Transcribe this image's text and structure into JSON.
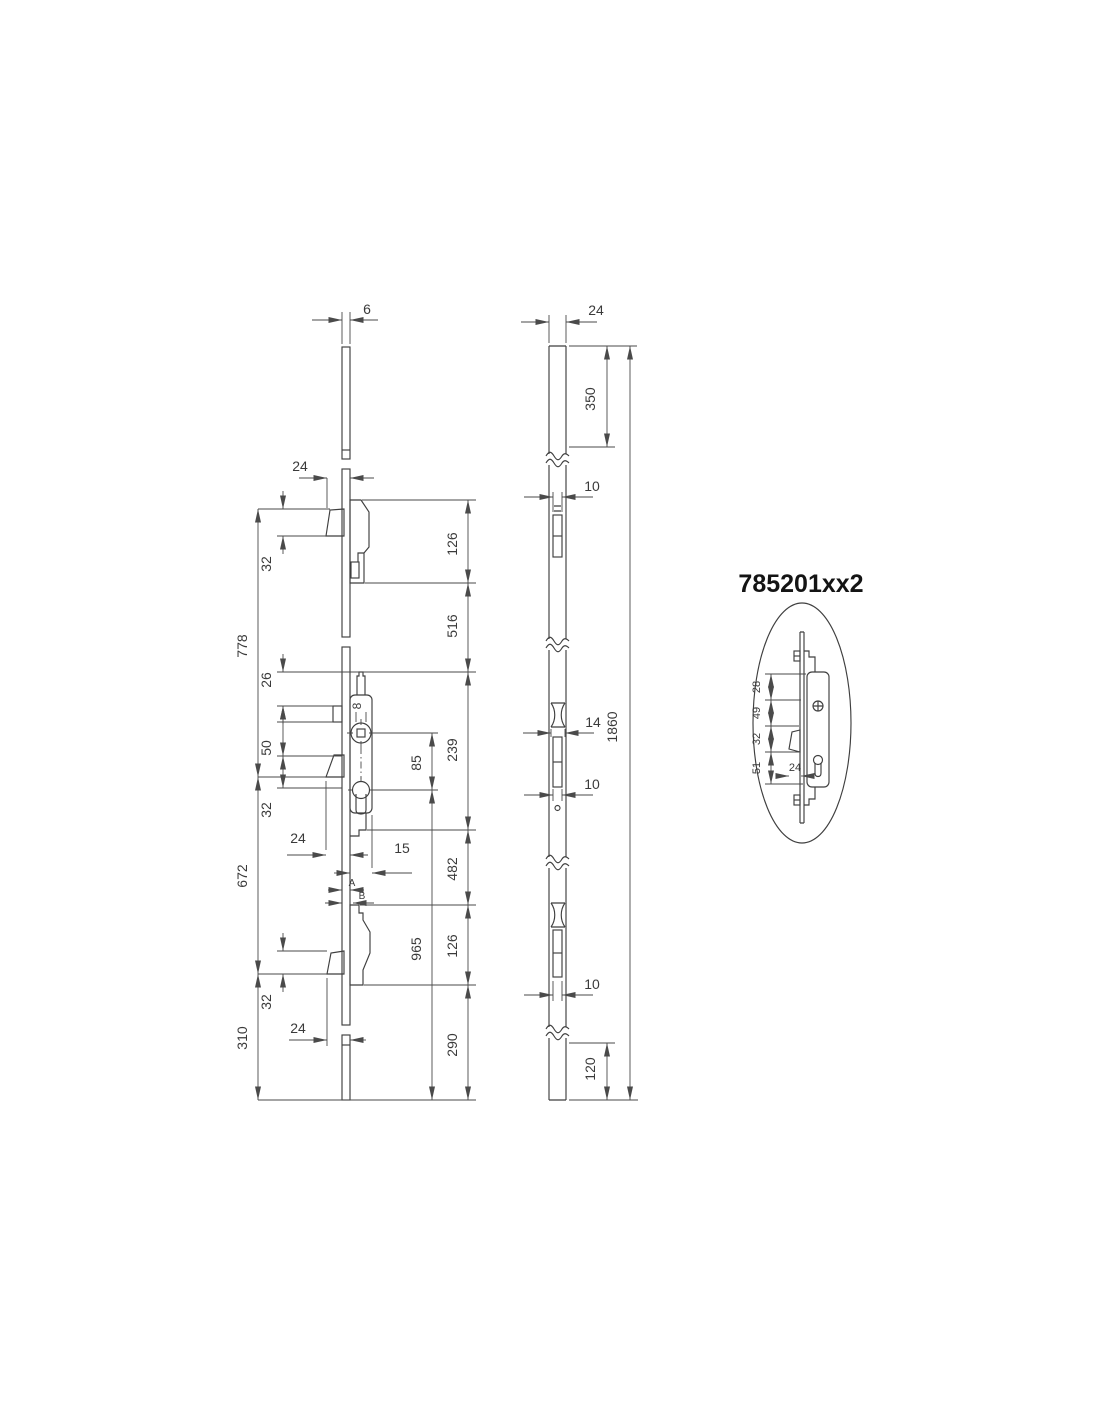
{
  "detail": {
    "part_number": "785201xx2",
    "d28": "28",
    "d49": "49",
    "d32": "32",
    "d51": "51",
    "d24": "24"
  },
  "side_view": {
    "thickness": "6",
    "top_hook": {
      "projection": "24",
      "height": "32"
    },
    "left_chain": {
      "a": "778",
      "b": "672",
      "c": "310"
    },
    "gearbox": {
      "d26": "26",
      "d50": "50",
      "d32": "32",
      "square": "8",
      "spacing": "85",
      "d24": "24",
      "d15": "15",
      "a": "A",
      "b": "B"
    },
    "bottom_hook": {
      "height": "32",
      "projection": "24"
    },
    "right_chain": {
      "a": "126",
      "b": "516",
      "c": "239",
      "d": "482",
      "e": "126",
      "f": "290"
    },
    "cyl_to_end": "965"
  },
  "front_view": {
    "width": "24",
    "top_to_slot": "350",
    "slot_top": "10",
    "cam_width": "14",
    "slot_mid": "10",
    "slot_bottom": "10",
    "overall": "1860",
    "bottom_end": "120"
  }
}
